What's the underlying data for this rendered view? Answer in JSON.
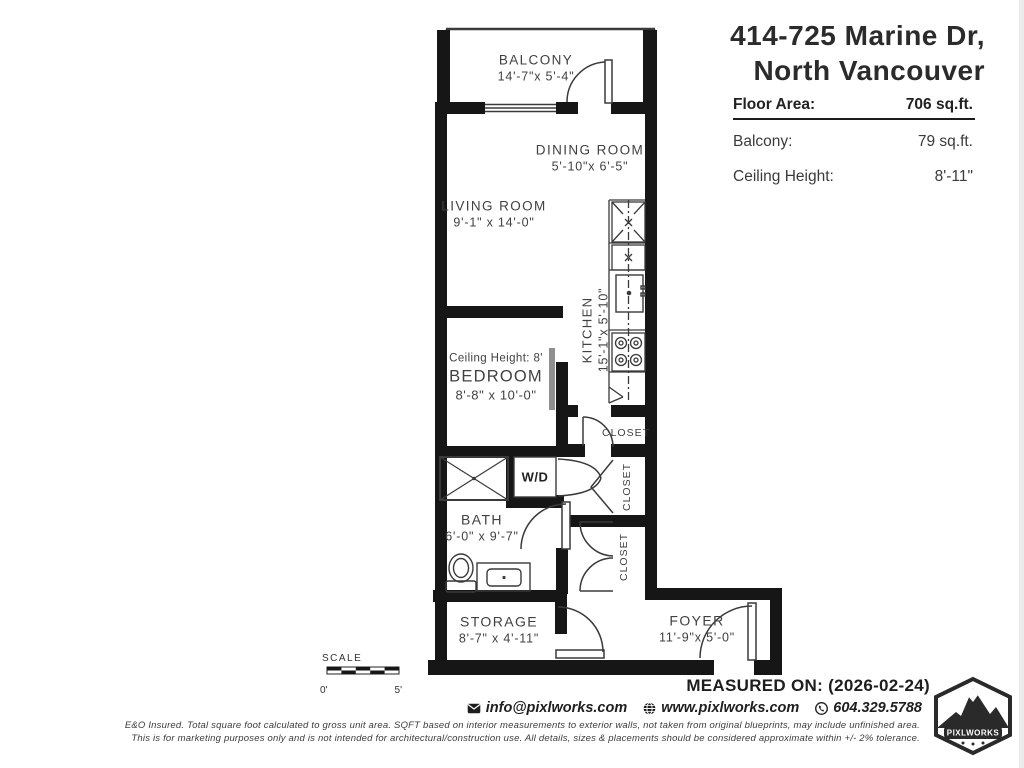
{
  "header": {
    "title_line1": "414-725 Marine Dr,",
    "title_line2": "North Vancouver",
    "area_rows": {
      "floor_area_label": "Floor Area:",
      "floor_area_value": "706 sq.ft.",
      "balcony_label": "Balcony:",
      "balcony_value": "79 sq.ft.",
      "ceiling_label": "Ceiling Height:",
      "ceiling_value": "8'-11\""
    }
  },
  "floorplan": {
    "rooms": {
      "balcony": {
        "name": "BALCONY",
        "dims": "14'-7\"x 5'-4\""
      },
      "dining": {
        "name": "DINING ROOM",
        "dims": "5'-10\"x 6'-5\""
      },
      "living": {
        "name": "LIVING ROOM",
        "dims": "9'-1\" x 14'-0\""
      },
      "kitchen": {
        "name": "KITCHEN",
        "dims": "15'-1\"x 5'-10\""
      },
      "bedroom": {
        "name": "BEDROOM",
        "dims": "8'-8\" x 10'-0\"",
        "note": "Ceiling Height: 8'"
      },
      "bath": {
        "name": "BATH",
        "dims": "6'-0\" x 9'-7\""
      },
      "storage": {
        "name": "STORAGE",
        "dims": "8'-7\" x 4'-11\""
      },
      "foyer": {
        "name": "FOYER",
        "dims": "11'-9\"x 5'-0\""
      }
    },
    "closet1": "CLOSET",
    "closet2": "CLOSET",
    "closet3": "CLOSET",
    "wd_label": "W/D",
    "scale": {
      "label": "SCALE",
      "start": "0'",
      "end": "5'"
    }
  },
  "footer": {
    "measured_on": "MEASURED ON: (2026-02-24)",
    "email": "info@pixlworks.com",
    "website": "www.pixlworks.com",
    "phone": "604.329.5788",
    "logo_text": "PIXLWORKS",
    "disclaimer_line1": "E&O Insured.  Total square foot calculated to gross unit area. SQFT based on interior measurements to exterior walls, not taken from original blueprints, may include unfinished area.",
    "disclaimer_line2": "This is for marketing purposes only and is not intended for architectural/construction use.  All details, sizes & placements should be considered approximate within +/- 2%  tolerance."
  },
  "colors": {
    "wall": "#161616",
    "line": "#3a3a3a",
    "accent_gray": "#8f8f8f"
  }
}
